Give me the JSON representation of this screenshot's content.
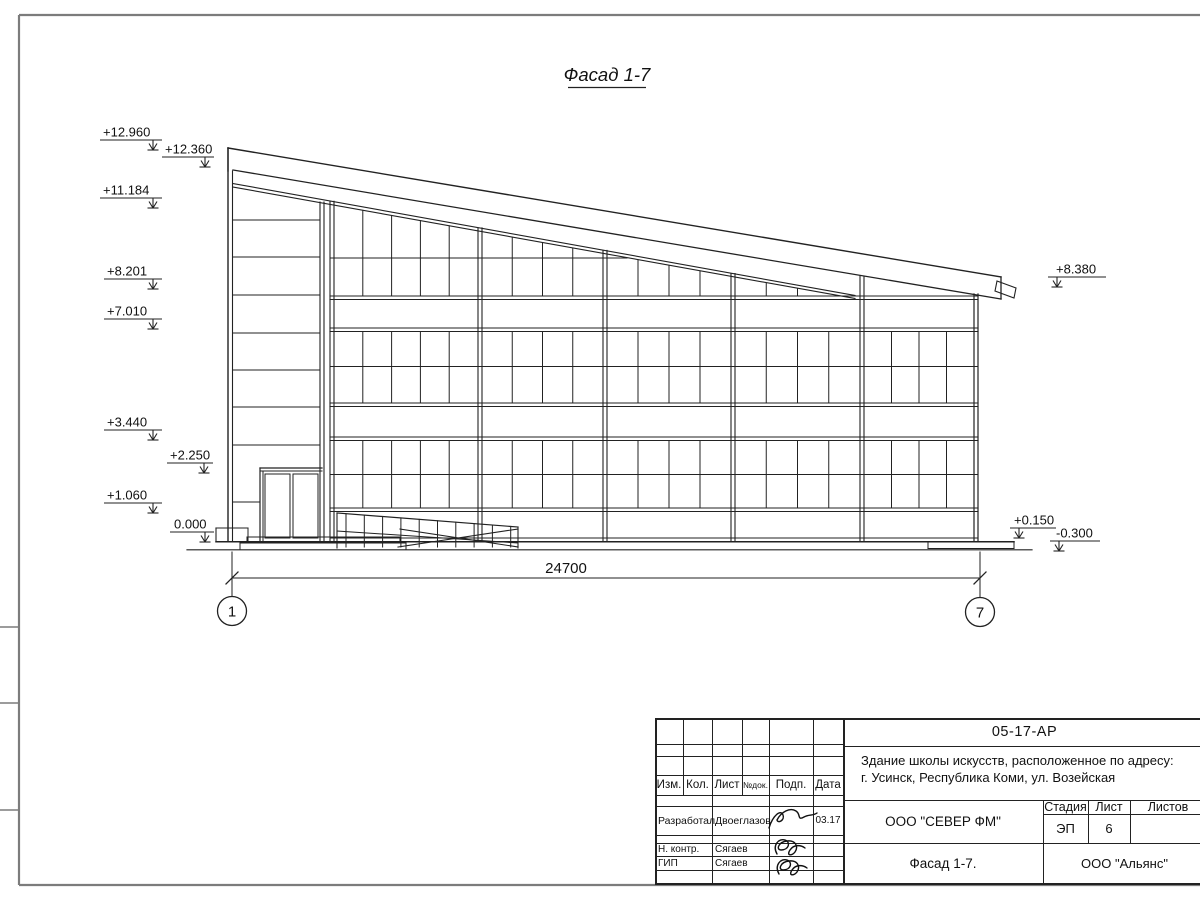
{
  "title": "Фасад 1-7",
  "drawing": {
    "left_marks": [
      "+12.960",
      "+12.360",
      "+11.184",
      "+8.201",
      "+7.010",
      "+3.440",
      "+2.250",
      "+1.060",
      "0.000"
    ],
    "right_marks": [
      "+8.380",
      "+0.150",
      "-0.300"
    ],
    "dimension": "24700",
    "axis_start": "1",
    "axis_end": "7",
    "line_color": "#222222",
    "frame_color": "#7c7c7c"
  },
  "title_block": {
    "doc_number": "05-17-АР",
    "project_line1": "Здание школы искусств, расположенное по адресу:",
    "project_line2": "г. Усинск, Республика Коми, ул. Возейская",
    "company": "ООО \"СЕВЕР ФМ\"",
    "sheet_title": "Фасад 1-7.",
    "contractor": "ООО \"Альянс\"",
    "stage_label": "Стадия",
    "sheet_label": "Лист",
    "sheets_label": "Листов",
    "stage_value": "ЭП",
    "sheet_value": "6",
    "columns": {
      "izm": "Изм.",
      "kol": "Кол.",
      "list": "Лист",
      "ndok": "№док.",
      "podp": "Подп.",
      "data": "Дата"
    },
    "rows": [
      {
        "role": "Разработал",
        "name": "Двоеглазов",
        "date": "03.17"
      },
      {
        "role": "Н. контр.",
        "name": "Сягаев",
        "date": ""
      },
      {
        "role": "ГИП",
        "name": "Сягаев",
        "date": ""
      }
    ]
  }
}
